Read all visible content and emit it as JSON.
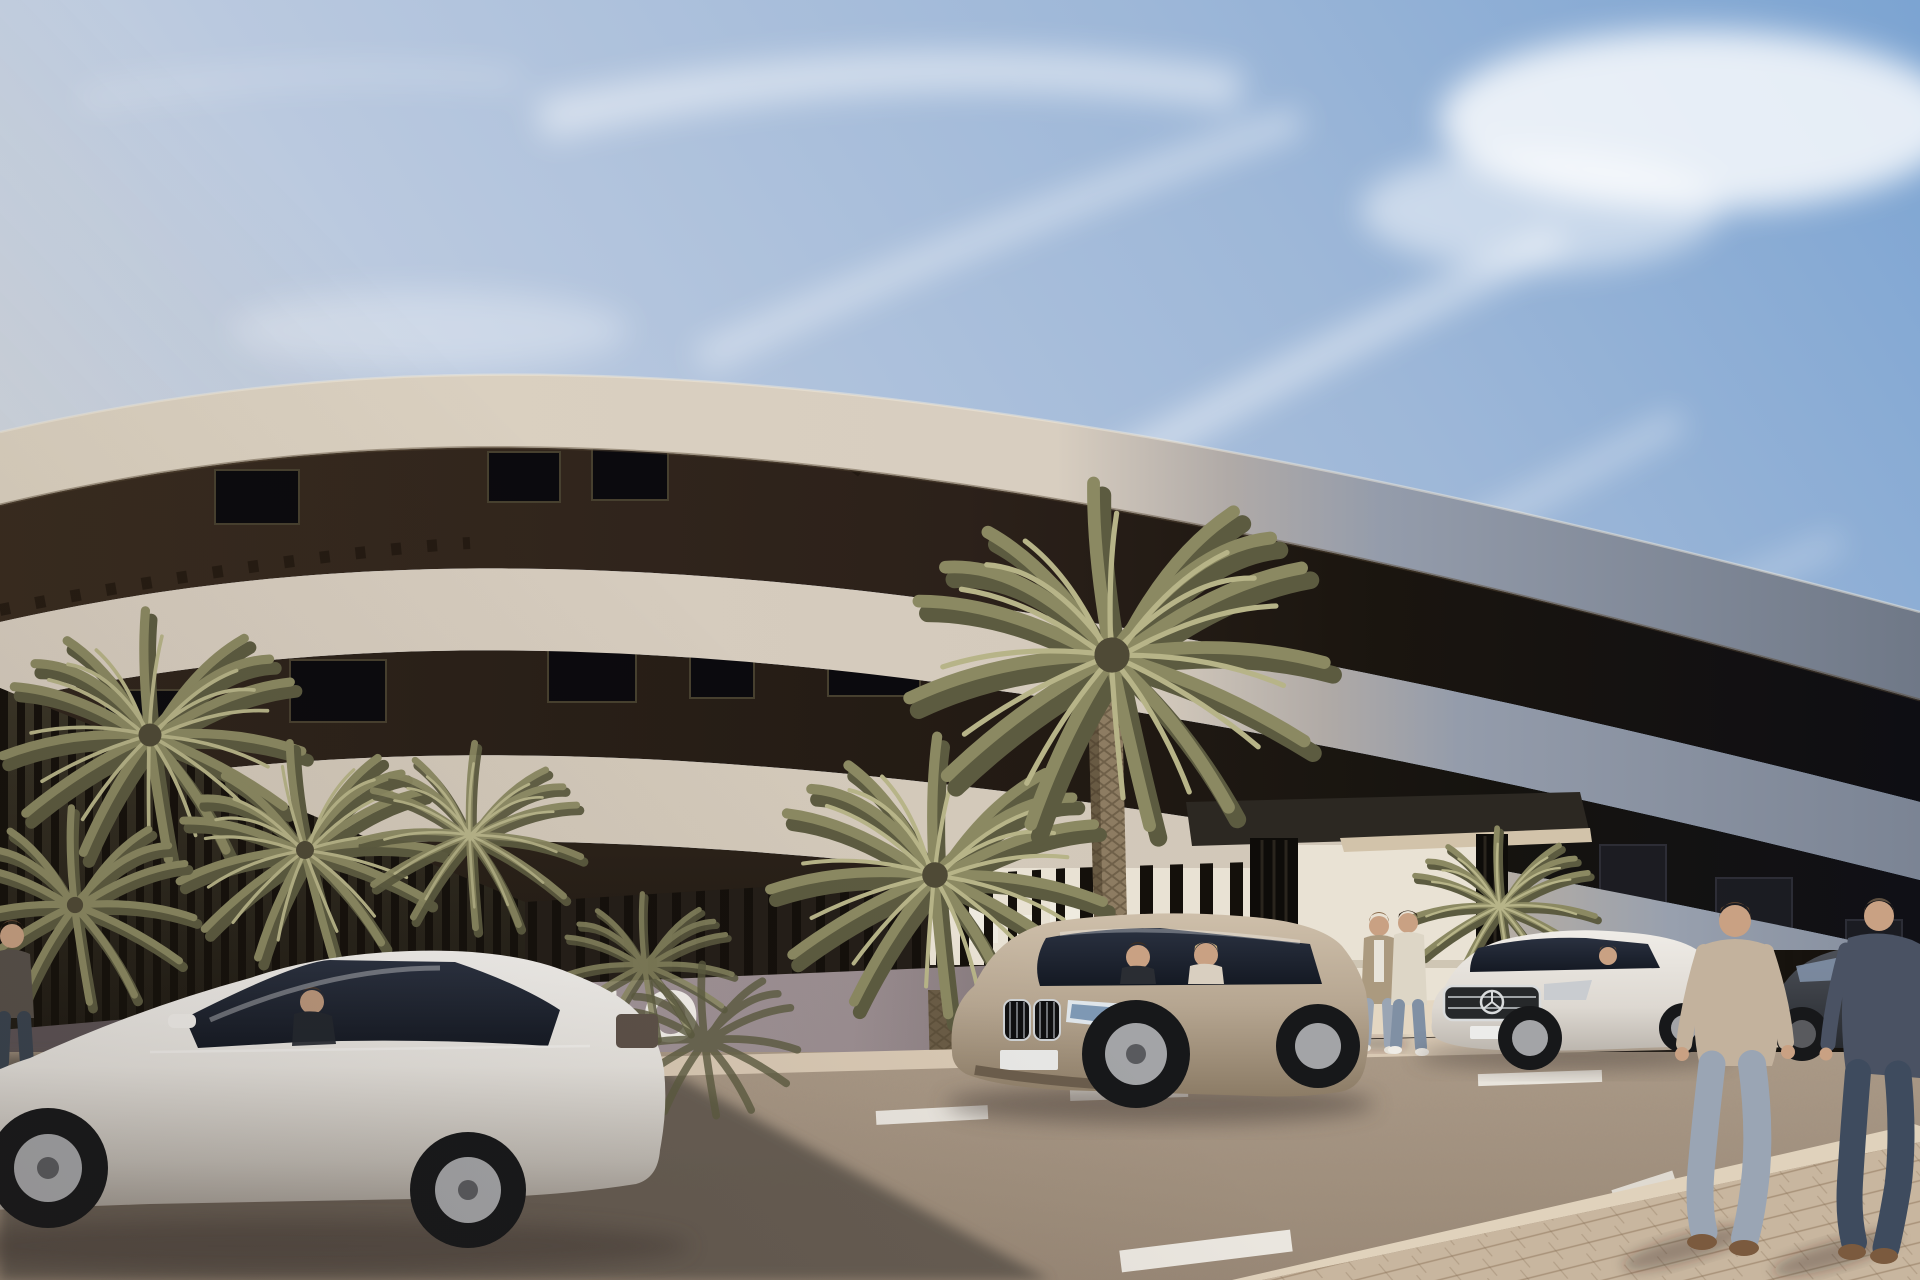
{
  "meta": {
    "title": "New-build curved apartment complex – exterior 3D render",
    "type": "architectural visualization, photorealistic",
    "time_of_day": "sunny day, light from upper right",
    "sky": "blue sky with diagonal wispy clouds, large white cloud top right"
  },
  "wall_sign": {
    "text": "TO",
    "note": "white capital letters on the low entrance wall, left part hidden behind parked white sedan"
  },
  "building": {
    "style": "modern curved apartment block, 3 storeys plus rooftop terrace",
    "features": [
      "sweeping cream fascia bands curving across full width",
      "right wing in blue-grey shadow",
      "dark recessed balcony floors with windows",
      "dark timber pergola slats along roof terrace",
      "flat entrance canopy on black slatted pillars",
      "black vertical-slat perimeter fence on low wall"
    ]
  },
  "vehicles": [
    {
      "name": "white-sedan",
      "color": "white",
      "position": "left foreground, parked facing left, driver inside"
    },
    {
      "name": "beige-suv",
      "color": "champagne beige",
      "position": "centre, parked at angle facing left, two occupants"
    },
    {
      "name": "white-mercedes",
      "color": "white",
      "position": "right of entrance, chrome grille with star badge"
    },
    {
      "name": "dark-car",
      "color": "dark grey",
      "position": "far right, partly hidden behind pedestrians"
    }
  ],
  "people": [
    {
      "name": "man-left-edge",
      "desc": "standing by wall, dark t-shirt and jeans, cropped by left edge"
    },
    {
      "name": "entrance-man-cardigan",
      "desc": "tan cardigan over white tee, blue jeans, talking at entrance walkway"
    },
    {
      "name": "entrance-man-cream",
      "desc": "cream sweater, blue jeans, back to camera at entrance"
    },
    {
      "name": "suv-passenger",
      "desc": "dark-haired front passenger in SUV"
    },
    {
      "name": "suv-driver",
      "desc": "blonde driver in SUV"
    },
    {
      "name": "sedan-driver",
      "desc": "driver silhouette inside white sedan"
    },
    {
      "name": "walking-man-beige",
      "desc": "walking away on right sidewalk, beige tee, faded jeans"
    },
    {
      "name": "walking-man-navy",
      "desc": "walking away far right, navy tee, dark jeans, cropped by edge"
    }
  ],
  "vegetation": [
    "cluster of feather palms behind fence on the left",
    "two tall date palms with diamond-pattern trunks in front of facade centre",
    "small fan palm beside entrance planter",
    "dark shrubs behind perimeter fence"
  ],
  "road": {
    "surface": "speckled asphalt, long building shadow across the left half",
    "markings": "white parking-bay dashes",
    "kerb": "pale sunlit kerb strip in front of wall",
    "sidewalk": "pale paved sidewalk wedge, lower right corner"
  },
  "palette": {
    "sky_top": "#7ca4d2",
    "sky_mid": "#bac9df",
    "sky_low": "#e9e7e2",
    "cloud": "#ffffff",
    "cream": "#dbd1c0",
    "cream_hi": "#f0e9dc",
    "cream_shade": "#b5a791",
    "grey_band": "#949cab",
    "grey_band_dark": "#6f7887",
    "recess_brown": "#2c211a",
    "recess_dark": "#12110f",
    "pergola": "#221911",
    "window_dark": "#0b0a0e",
    "frame_light": "#47402f",
    "fence": "#14100b",
    "garden_dark": "#2e2920",
    "wall_dark": "#5b5255",
    "sign_wall": "#9b8e91",
    "sign_wall_dark": "#7d7174",
    "sign_text": "#f2efe9",
    "end_cap": "#d9d1c6",
    "curb": "#d9c9b4",
    "road": "#998876",
    "road_light": "#ab9a87",
    "road_shadow": "#5f564e",
    "deep_shadow": "#463e37",
    "sidewalk": "#c8b69f",
    "paver_line": "#97816a",
    "palm_dark": "#5c5b40",
    "palm_main": "#8b8962",
    "palm_light": "#b7b488",
    "palm_core": "#4f4a36",
    "trunk": "#8d7c62",
    "trunk_shade": "#6a5c46",
    "glass": "#1d2330",
    "glass_hi": "#8494ac",
    "tire": "#17181a",
    "alloy": "#a3a4a7",
    "hub": "#595a5e",
    "sedan": "#eceae6",
    "suv": "#bfae97",
    "merc": "#e3dfd9",
    "car_dark": "#383b41",
    "skin": "#c9a183",
    "hair": "#5d4430",
    "hair_light": "#8a6a4a",
    "tee_beige": "#c3b29d",
    "tee_navy": "#4a5263",
    "jeans_light": "#9aa5b4",
    "jeans_dark": "#3e4b5e",
    "cream_top": "#ddd6c6",
    "cardigan": "#ab9a7f",
    "shoe": "#7b5a3e",
    "canopy_dark": "#2c2822",
    "canopy_light": "#d2c3aa",
    "backdrop": "#e9e2d4",
    "planter": "#ded7ca",
    "walkway": "#e4d7c2"
  }
}
